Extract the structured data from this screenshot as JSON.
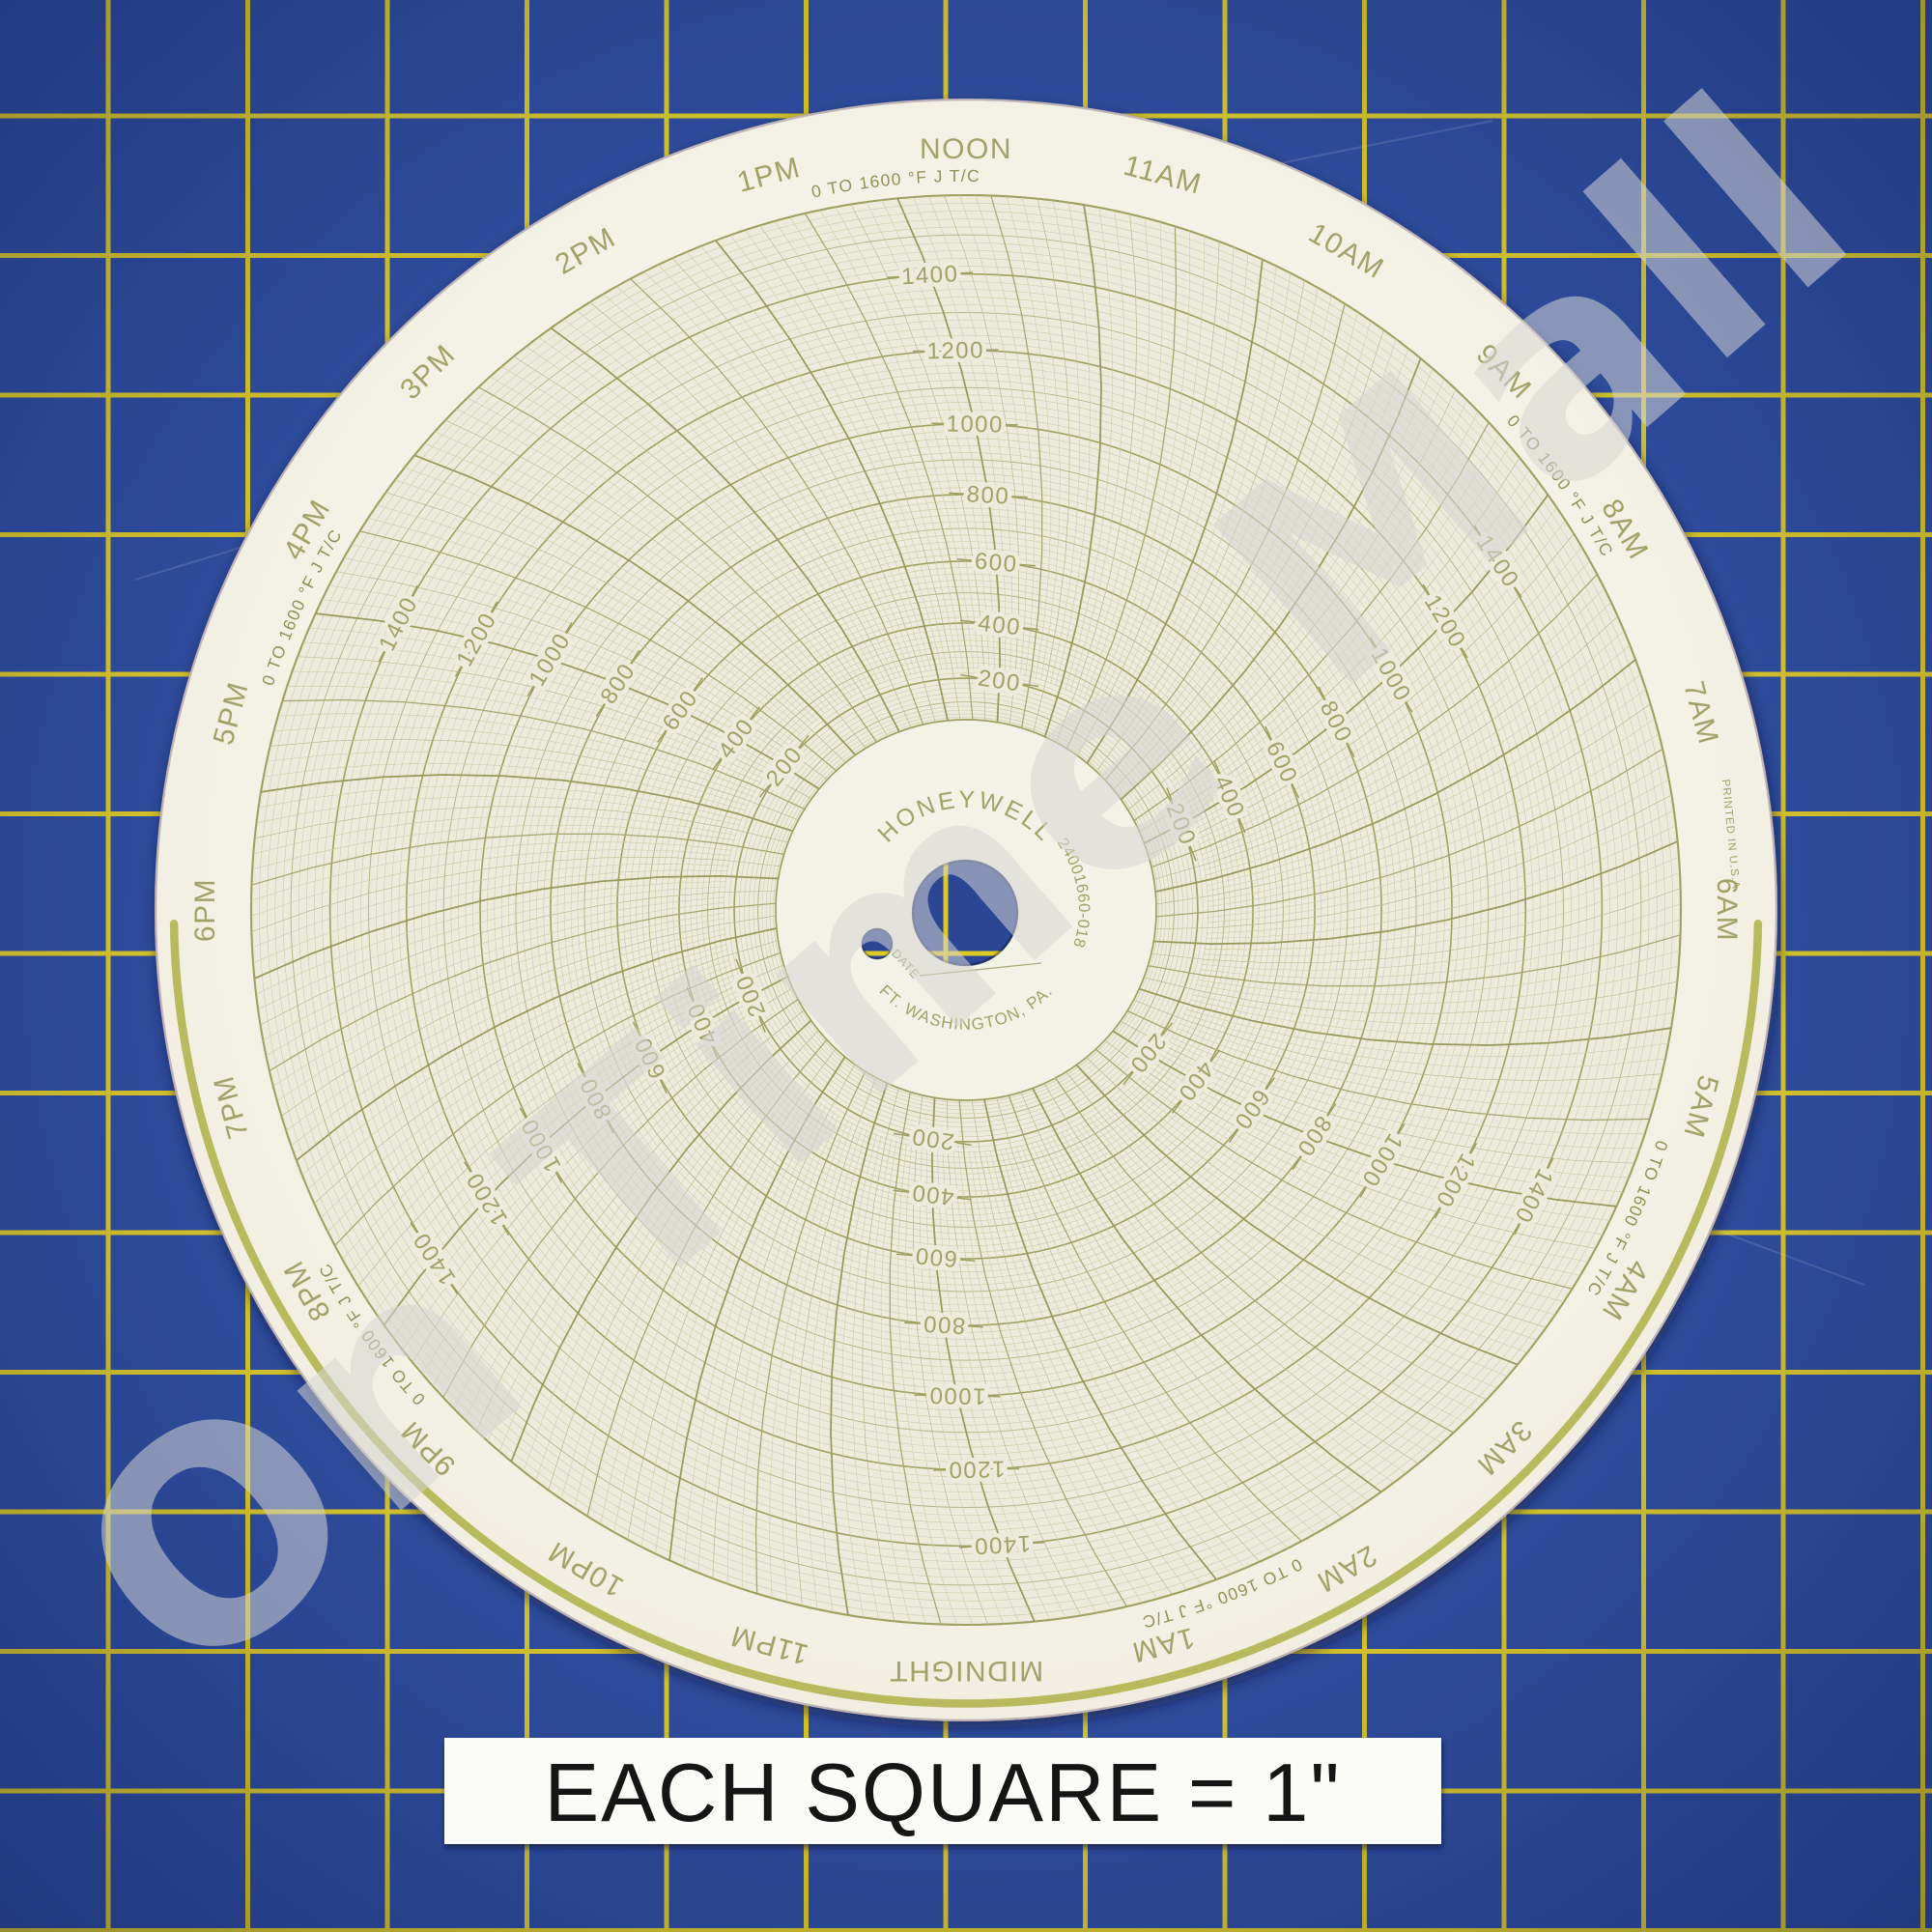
{
  "photo": {
    "caption_label": {
      "text": "EACH SQUARE = 1\""
    },
    "watermark": {
      "text": "On Time Mall"
    },
    "mat": {
      "base_color": "#2e4c9c",
      "grid_line_color": "#dcc926",
      "grid_spacing_px": 144.5,
      "grid_offset_x": 112,
      "grid_offset_y": 120,
      "grid_line_width": 5
    }
  },
  "chart_data": {
    "type": "polar-grid",
    "description": "Blank 24-hour circular chart recorder paper, no recorded trace",
    "title": "HONEYWELL 24001660-018",
    "range_label": "0 TO 1600 °F J T/C",
    "scale": {
      "min": 0,
      "max": 1600,
      "minor_step": 20,
      "medium_step": 100,
      "major_step": 200,
      "labeled_values": [
        200,
        400,
        600,
        800,
        1000,
        1200,
        1400
      ],
      "units": "°F",
      "sensor": "J T/C"
    },
    "time_labels_clockwise_from_top": [
      "NOON",
      "11AM",
      "10AM",
      "9AM",
      "8AM",
      "7AM",
      "6AM",
      "5AM",
      "4AM",
      "3AM",
      "2AM",
      "1AM",
      "MIDNIGHT",
      "11PM",
      "10PM",
      "9PM",
      "8PM",
      "7PM",
      "6PM",
      "5PM",
      "4PM",
      "3PM",
      "2PM",
      "1PM"
    ],
    "time_minor_step_minutes": 5,
    "value_label_spoke_hours": [
      "NOON",
      "8AM",
      "4AM",
      "MIDNIGHT",
      "8PM",
      "4PM"
    ],
    "range_label_angles_deg_cw_from_top": [
      354.5,
      54.5,
      115,
      159.5,
      234.5,
      294.5
    ],
    "rim_arc_span_deg_cw_from_top": [
      91,
      269
    ],
    "series": []
  },
  "disc": {
    "brand": "HONEYWELL",
    "part_number": "24001660-018",
    "location": "FT. WASHINGTON, PA.",
    "date_label": "DATE",
    "printed_note": "PRINTED IN U.S.A.",
    "colors": {
      "paper": "#f3f1e5",
      "grid_area": "#edebdb",
      "line_fine": "#c9caa7",
      "line_medium": "#b2b384",
      "line_major": "#9da05f",
      "hour_line": "#979a5b",
      "half_hour_line": "#a4a66e",
      "label_text": "#a0a268",
      "range_text": "#8f9157",
      "rim_arc": "#b9ba5e"
    }
  }
}
